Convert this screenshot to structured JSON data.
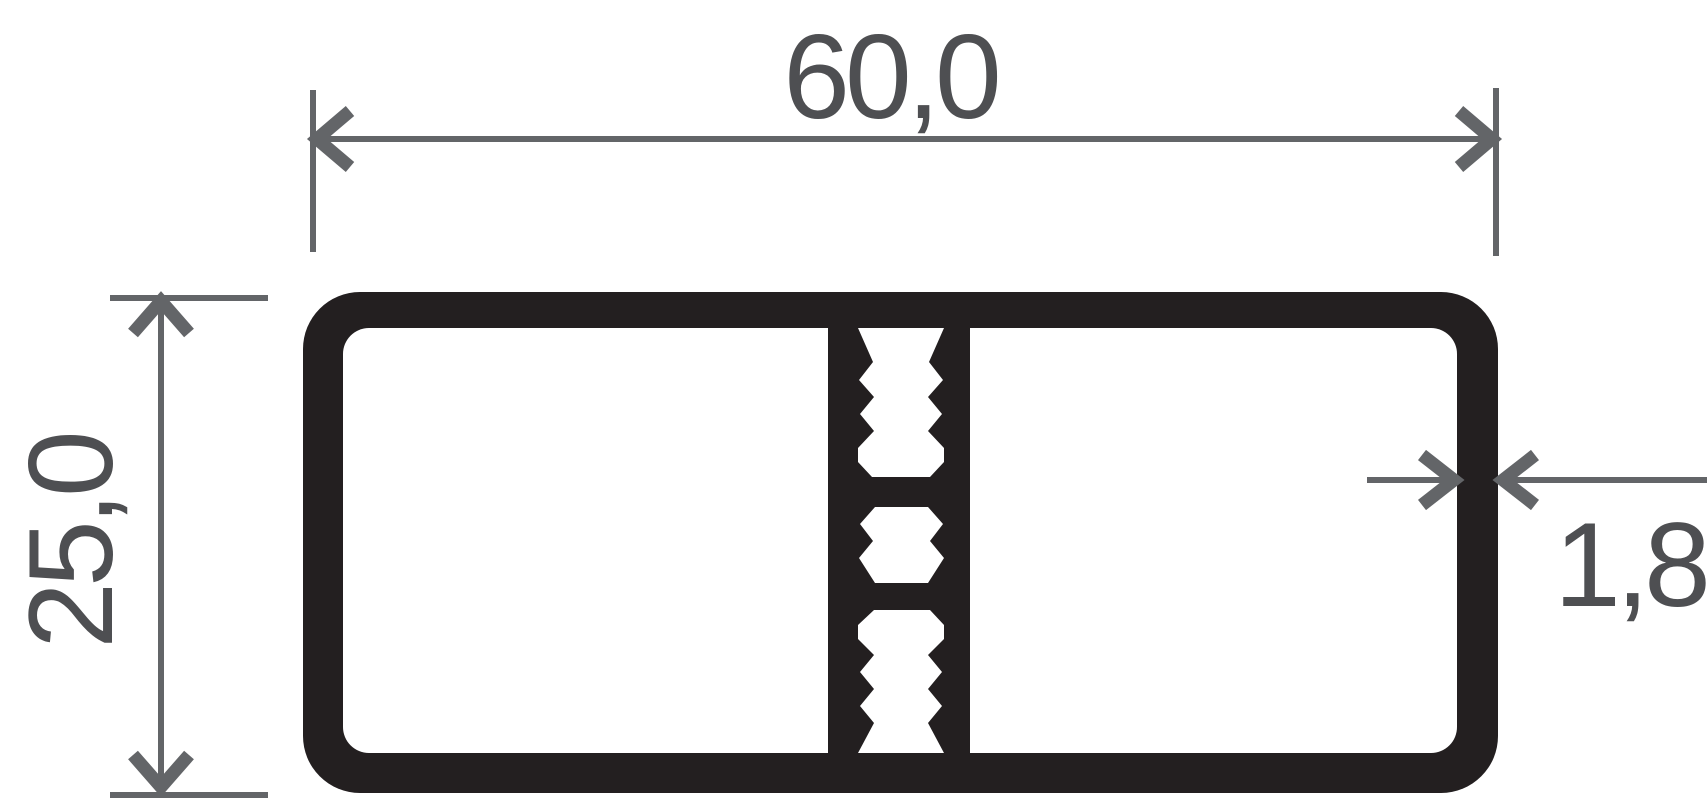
{
  "diagram": {
    "type": "profile-cross-section-drawing",
    "dimension_width": {
      "label": "60,0"
    },
    "dimension_height": {
      "label": "25,0"
    },
    "dimension_thickness": {
      "label": "1,8"
    },
    "colors": {
      "profile": "#231f20",
      "dimension_line": "#636568",
      "dimension_text": "#4e4f52",
      "background": "#ffffff"
    }
  }
}
